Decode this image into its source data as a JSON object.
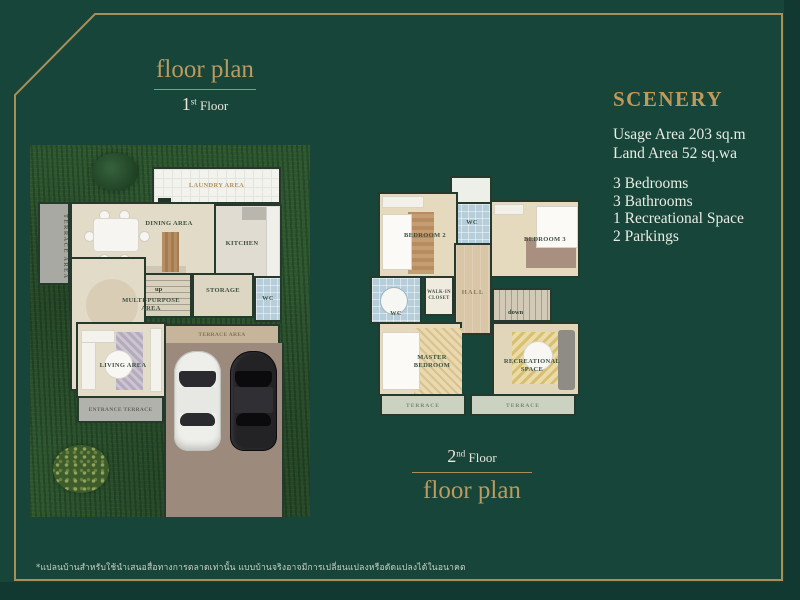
{
  "palette": {
    "background_green": "#17453a",
    "frame_gold": "#a98e58",
    "accent_gold": "#bd9a5e",
    "text_white": "#e9ece3",
    "grass_green": "#2e5731",
    "wall_green": "#26392d",
    "floor_cream": "#e1dbc7",
    "wc_blue": "#b6cdda",
    "parking_brown": "#9c8a7d"
  },
  "plan1": {
    "header": {
      "title": "floor plan",
      "floor_number": "1",
      "floor_ordinal": "st",
      "floor_word": "Floor"
    },
    "rooms": {
      "laundry": "LAUNDRY AREA",
      "side_terrace": "TERRACE AREA",
      "dining": "DINING AREA",
      "kitchen": "KITCHEN",
      "up": "up",
      "storage": "STORAGE",
      "wc": "WC",
      "multi_line1": "MULTI-PURPOSE",
      "multi_line2": "AREA",
      "living": "LIVING AREA",
      "entrance": "ENTRANCE TERRACE",
      "terrace_band": "TERRACE AREA"
    }
  },
  "plan2": {
    "footer": {
      "title": "floor plan",
      "floor_number": "2",
      "floor_ordinal": "nd",
      "floor_word": "Floor"
    },
    "rooms": {
      "wc_top": "WC",
      "bedroom2": "BEDROOM 2",
      "bedroom3": "BEDROOM 3",
      "wc_left": "WC",
      "walkin_line1": "WALK-IN",
      "walkin_line2": "CLOSET",
      "hall": "HALL",
      "down": "down",
      "master_line1": "MASTER",
      "master_line2": "BEDROOM",
      "rec_line1": "RECREATIONAL",
      "rec_line2": "SPACE",
      "terrace_left": "TERRACE",
      "terrace_right": "TERRACE"
    }
  },
  "info": {
    "title": "SCENERY",
    "area_lines": [
      "Usage Area 203 sq.m",
      "Land Area 52 sq.wa"
    ],
    "features": [
      "3 Bedrooms",
      "3 Bathrooms",
      "1 Recreational Space",
      "2 Parkings"
    ]
  },
  "disclaimer": "*แปลนบ้านสำหรับใช้นำเสนอสื่อทางการตลาดเท่านั้น แบบบ้านจริงอาจมีการเปลี่ยนแปลงหรือดัดแปลงได้ในอนาคต"
}
